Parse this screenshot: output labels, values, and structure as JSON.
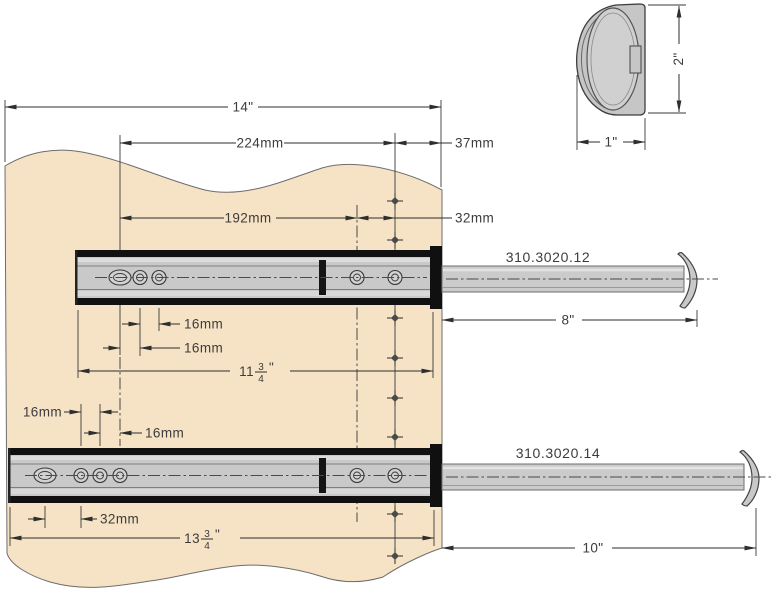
{
  "drawing_title": "Drawer slide mounting dimensions",
  "colors": {
    "panel": "#f6e3c5",
    "panel_outline": "#6d6d6d",
    "slide_body": "#c9c9c9",
    "slide_black": "#111111",
    "rod": "#cbcbcb",
    "line": "#2e2e2e",
    "text": "#3c3c3c"
  },
  "detail": {
    "height": "2\"",
    "width": "1\""
  },
  "top_dims": {
    "panel_width": "14\"",
    "back_span": "224mm",
    "front_offset": "37mm",
    "mid_span": "192mm",
    "col_gap": "32mm"
  },
  "slide1": {
    "part": "310.3020.12",
    "pitch_a": "16mm",
    "pitch_b": "16mm",
    "len_whole": "11",
    "len_num": "3",
    "len_den": "4",
    "len_unit": "\"",
    "extension": "8\""
  },
  "slide2": {
    "part": "310.3020.14",
    "pitch_a": "16mm",
    "pitch_b": "16mm",
    "front_pitch": "32mm",
    "len_whole": "13",
    "len_num": "3",
    "len_den": "4",
    "len_unit": "\"",
    "extension": "10\""
  }
}
